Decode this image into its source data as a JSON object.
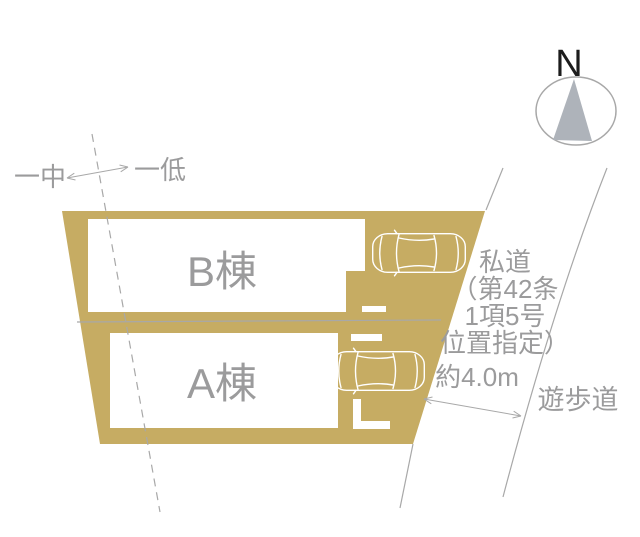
{
  "site_plan": {
    "compass": {
      "north_label": "N"
    },
    "zoning_boundary": {
      "left_label": "一中",
      "right_label": "一低"
    },
    "buildings": [
      {
        "label": "B棟"
      },
      {
        "label": "A棟"
      }
    ],
    "private_road": {
      "label_lines": [
        "私道",
        "（第42条",
        "1項5号",
        "位置指定）"
      ],
      "width_label": "約4.0m"
    },
    "promenade": {
      "label": "遊歩道"
    },
    "colors": {
      "lot_fill": "#c6ac63",
      "building_fill": "#ffffff",
      "label_gray": "#9b9b9c",
      "line_gray": "#a8a8a8",
      "compass_needle_gray": "#aeb3ba",
      "compass_letter_black": "#1c1c1c"
    }
  }
}
